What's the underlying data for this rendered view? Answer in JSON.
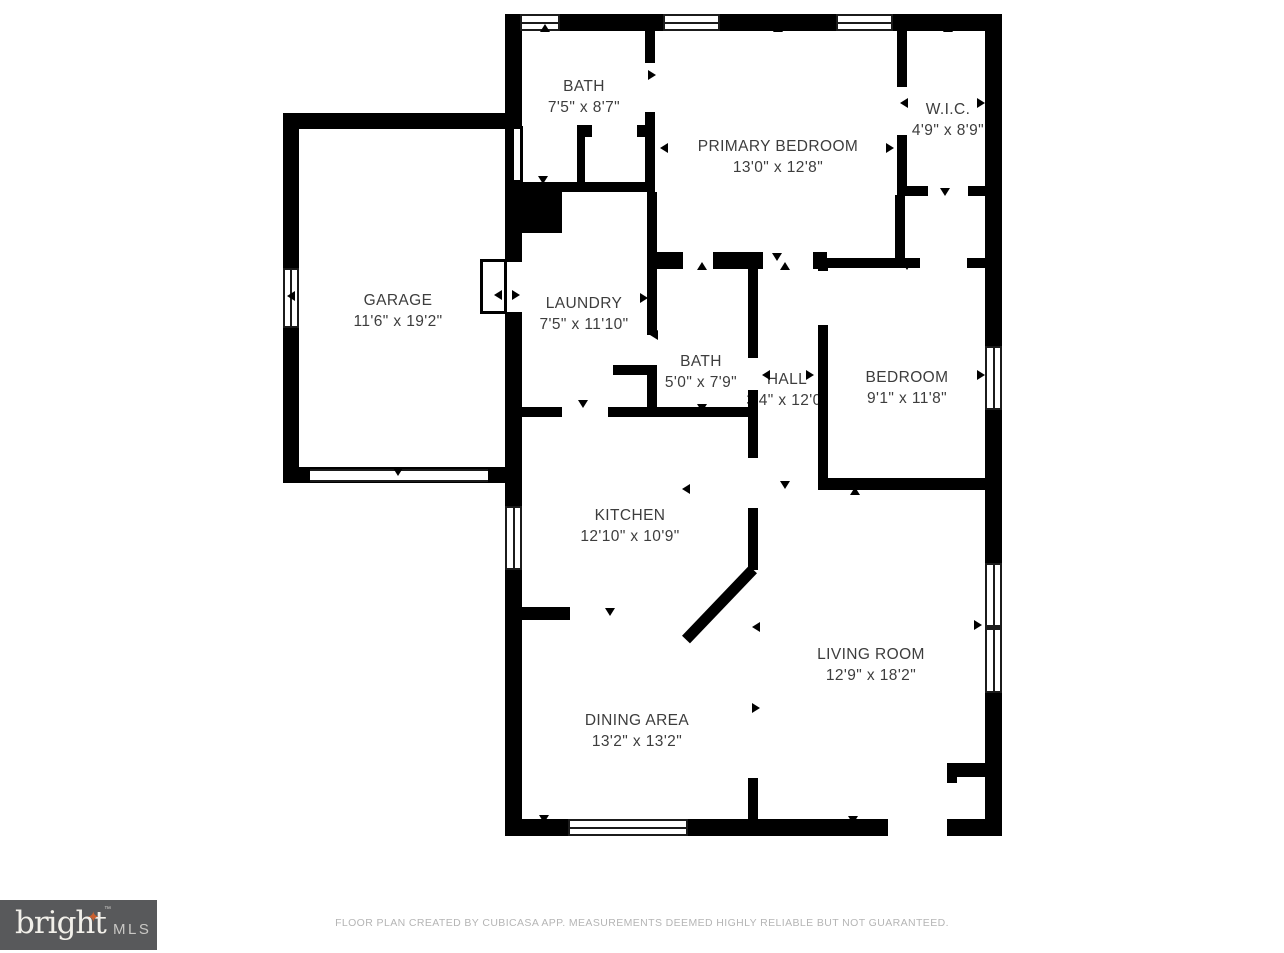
{
  "floorplan": {
    "rooms": [
      {
        "name": "BATH",
        "dims": "7'5\" x 8'7\""
      },
      {
        "name": "PRIMARY BEDROOM",
        "dims": "13'0\" x 12'8\""
      },
      {
        "name": "W.I.C.",
        "dims": "4'9\" x 8'9\""
      },
      {
        "name": "GARAGE",
        "dims": "11'6\" x 19'2\""
      },
      {
        "name": "LAUNDRY",
        "dims": "7'5\" x 11'10\""
      },
      {
        "name": "BATH",
        "dims": "5'0\" x 7'9\""
      },
      {
        "name": "HALL",
        "dims": "3'4\" x 12'0\""
      },
      {
        "name": "BEDROOM",
        "dims": "9'1\" x 11'8\""
      },
      {
        "name": "KITCHEN",
        "dims": "12'10\" x 10'9\""
      },
      {
        "name": "LIVING ROOM",
        "dims": "12'9\" x 18'2\""
      },
      {
        "name": "DINING AREA",
        "dims": "13'2\" x 13'2\""
      }
    ],
    "colors": {
      "wall": "#000000",
      "label_text": "#3d3d3d",
      "logo_background": "#58595b",
      "logo_star": "#c95f2e",
      "disclaimer_text": "#b5b5b5"
    }
  },
  "footer": {
    "logo": {
      "brand": "bright",
      "mls": "MLS",
      "tm": "™",
      "star": "✦"
    },
    "disclaimer": "FLOOR PLAN CREATED BY CUBICASA APP. MEASUREMENTS DEEMED HIGHLY RELIABLE BUT NOT GUARANTEED."
  }
}
